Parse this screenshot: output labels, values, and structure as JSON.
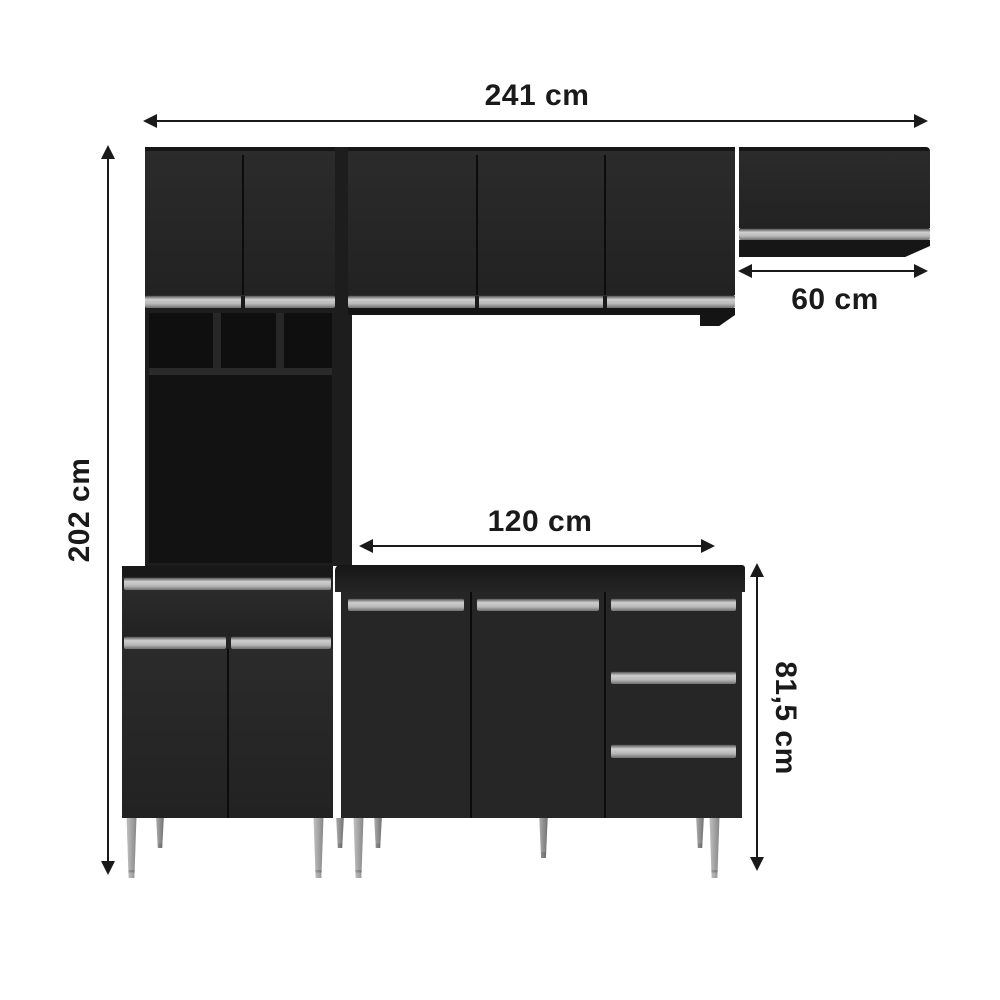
{
  "diagram": {
    "subject": "black kitchen cabinet set with dimension annotations",
    "background_color": "#ffffff",
    "annotation_color": "#1a1a1a",
    "cabinet_body_color": "#262626",
    "cabinet_interior_color": "#0f0f0f",
    "handle_strip_color": "#bfbfbf",
    "leg_color": "#a9a9a9",
    "labels": {
      "total_width": "241 cm",
      "total_height": "202 cm",
      "upper_right_cabinet_width": "60 cm",
      "counter_width": "120 cm",
      "counter_height": "81,5 cm"
    }
  }
}
